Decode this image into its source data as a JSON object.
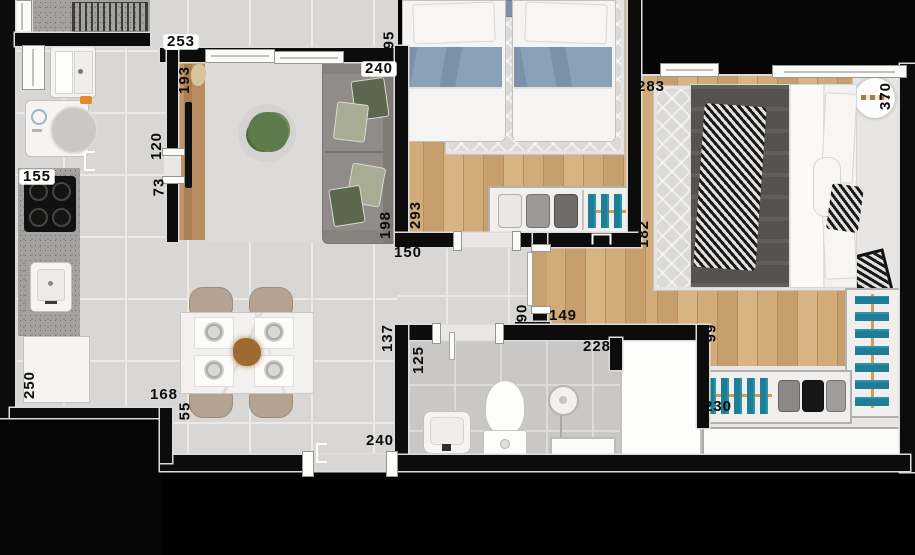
{
  "plan_type": "apartment-floor-plan-top-view",
  "dims": {
    "d253": "253",
    "d95": "95",
    "d193": "193",
    "d240_sofa": "240",
    "d120": "120",
    "d73": "73",
    "d155": "155",
    "d198": "198",
    "d293": "293",
    "d150": "150",
    "d283": "283",
    "d370": "370",
    "d182": "182",
    "d90": "90",
    "d149": "149",
    "d137": "137",
    "d125": "125",
    "d228": "228",
    "d99": "99",
    "d230": "230",
    "d250": "250",
    "d168": "168",
    "d55": "55",
    "d240_entry": "240"
  },
  "colors": {
    "wall": "#0c0c0c",
    "tile": "#d8d7d5",
    "grout": "#ecebe9",
    "bath_tile": "#c9c8c6",
    "wood": "#c8a170",
    "rug": "#dbdad8",
    "granite": "#a3a2a0",
    "marble": "#f2f1ef",
    "sofa": "#8f8c89",
    "pillow_green": "#5c684d",
    "pillow_sage": "#a9ac94",
    "blanket_blue": "#8ba1b7",
    "duvet_dark": "#55524f",
    "clothes_teal": "#1e7e95",
    "closet_rail": "#d99a4e",
    "tv_panel": "#b0885a",
    "chair": "#b4a393",
    "plant": "#5e7b4b",
    "soap_orange": "#e08a28"
  }
}
